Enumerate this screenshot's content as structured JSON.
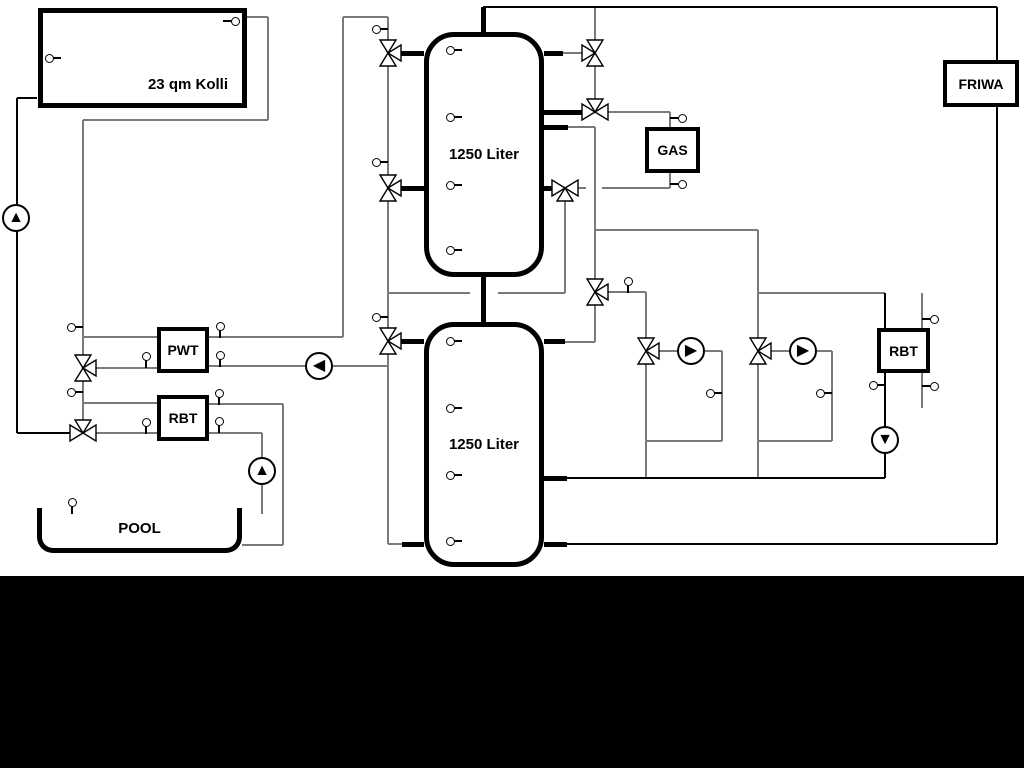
{
  "labels": {
    "collector": "23 qm Kolli",
    "tank_top": "1250 Liter",
    "tank_bottom": "1250 Liter",
    "gas": "GAS",
    "friwa": "FRIWA",
    "pwt": "PWT",
    "rbt_left": "RBT",
    "rbt_right": "RBT",
    "pool": "POOL"
  },
  "colors": {
    "background": "#ffffff",
    "bottom_bar": "#000000",
    "pipe_gray": "#7a7a7a",
    "pipe_black": "#000000",
    "symbol_fill": "#ffffff",
    "symbol_stroke": "#000000"
  },
  "icons": {
    "pump_up": "▲",
    "pump_down": "▼",
    "pump_left": "◀",
    "pump_right": "▶",
    "valve_3way": "bowtie-with-side-triangle",
    "sensor": "small-circle-with-stem"
  },
  "diagram": {
    "bottom_bar": {
      "x": 0,
      "y": 576,
      "w": 1024,
      "h": 192
    },
    "boxes": [
      {
        "id": "collector",
        "label_key": "labels.collector",
        "x": 38,
        "y": 8,
        "w": 209,
        "h": 100,
        "bw": 5,
        "fs": 15,
        "lbl_pos": "br",
        "name": "solar-collector-box"
      },
      {
        "id": "gas",
        "label_key": "labels.gas",
        "x": 645,
        "y": 127,
        "w": 55,
        "h": 46,
        "bw": 4,
        "fs": 14,
        "lbl_pos": "c",
        "name": "gas-boiler-box"
      },
      {
        "id": "friwa",
        "label_key": "labels.friwa",
        "x": 943,
        "y": 60,
        "w": 76,
        "h": 47,
        "bw": 4,
        "fs": 14,
        "lbl_pos": "c",
        "name": "friwa-station-box"
      },
      {
        "id": "pwt",
        "label_key": "labels.pwt",
        "x": 157,
        "y": 327,
        "w": 52,
        "h": 46,
        "bw": 4,
        "fs": 14,
        "lbl_pos": "c",
        "name": "pwt-heat-exchanger-box"
      },
      {
        "id": "rbt_left",
        "label_key": "labels.rbt_left",
        "x": 157,
        "y": 395,
        "w": 52,
        "h": 46,
        "bw": 4,
        "fs": 14,
        "lbl_pos": "c",
        "name": "rbt-heat-exchanger-left-box"
      },
      {
        "id": "rbt_right",
        "label_key": "labels.rbt_right",
        "x": 877,
        "y": 328,
        "w": 53,
        "h": 45,
        "bw": 4,
        "fs": 14,
        "lbl_pos": "c",
        "name": "rbt-heat-exchanger-right-box"
      }
    ],
    "tanks": [
      {
        "id": "tank_top",
        "label_key": "labels.tank_top",
        "x": 424,
        "y": 32,
        "w": 120,
        "h": 245,
        "name": "buffer-tank-top"
      },
      {
        "id": "tank_bottom",
        "label_key": "labels.tank_bottom",
        "x": 424,
        "y": 322,
        "w": 120,
        "h": 245,
        "name": "buffer-tank-bottom"
      }
    ],
    "pool": {
      "label_key": "labels.pool",
      "x": 37,
      "y": 508,
      "w": 205,
      "h": 45,
      "name": "pool-basin"
    },
    "pipes": [
      [
        17,
        98,
        37,
        98,
        2,
        "k"
      ],
      [
        17,
        98,
        17,
        433,
        2,
        "k"
      ],
      [
        17,
        433,
        70,
        433,
        2,
        "k"
      ],
      [
        247,
        17,
        268,
        17,
        2,
        "g"
      ],
      [
        268,
        17,
        268,
        120,
        2,
        "g"
      ],
      [
        83,
        120,
        268,
        120,
        2,
        "g"
      ],
      [
        83,
        120,
        83,
        355,
        2,
        "g"
      ],
      [
        83,
        381,
        83,
        420,
        2,
        "g"
      ],
      [
        83,
        337,
        157,
        337,
        2,
        "g"
      ],
      [
        96,
        368,
        157,
        368,
        2,
        "g"
      ],
      [
        209,
        337,
        343,
        337,
        2,
        "g"
      ],
      [
        343,
        17,
        343,
        337,
        2,
        "g"
      ],
      [
        343,
        17,
        388,
        17,
        2,
        "g"
      ],
      [
        209,
        366,
        388,
        366,
        2,
        "g"
      ],
      [
        83,
        403,
        157,
        403,
        2,
        "g"
      ],
      [
        96,
        433,
        157,
        433,
        2,
        "g"
      ],
      [
        209,
        404,
        283,
        404,
        2,
        "g"
      ],
      [
        283,
        404,
        283,
        545,
        2,
        "g"
      ],
      [
        242,
        545,
        283,
        545,
        2,
        "g"
      ],
      [
        209,
        433,
        262,
        433,
        2,
        "g"
      ],
      [
        262,
        433,
        262,
        514,
        2,
        "g"
      ],
      [
        388,
        17,
        388,
        40,
        2,
        "g"
      ],
      [
        388,
        66,
        388,
        175,
        2,
        "g"
      ],
      [
        388,
        201,
        388,
        328,
        2,
        "g"
      ],
      [
        388,
        354,
        388,
        544,
        2,
        "g"
      ],
      [
        388,
        544,
        402,
        544,
        2,
        "g"
      ],
      [
        388,
        293,
        470,
        293,
        2,
        "g"
      ],
      [
        498,
        293,
        565,
        293,
        2,
        "g"
      ],
      [
        565,
        201,
        565,
        293,
        2,
        "g"
      ],
      [
        578,
        188,
        586,
        188,
        2,
        "g"
      ],
      [
        602,
        188,
        670,
        188,
        2,
        "g"
      ],
      [
        670,
        173,
        670,
        188,
        2,
        "g"
      ],
      [
        608,
        112,
        670,
        112,
        2,
        "g"
      ],
      [
        670,
        112,
        670,
        127,
        2,
        "g"
      ],
      [
        568,
        127,
        595,
        127,
        2,
        "g"
      ],
      [
        595,
        127,
        595,
        279,
        2,
        "g"
      ],
      [
        595,
        305,
        595,
        342,
        2,
        "g"
      ],
      [
        565,
        342,
        595,
        342,
        2,
        "g"
      ],
      [
        595,
        7,
        595,
        40,
        2,
        "g"
      ],
      [
        595,
        66,
        595,
        99,
        2,
        "g"
      ],
      [
        563,
        53,
        582,
        53,
        2,
        "g"
      ],
      [
        595,
        230,
        758,
        230,
        2,
        "g"
      ],
      [
        758,
        230,
        758,
        338,
        2,
        "g"
      ],
      [
        608,
        292,
        646,
        292,
        2,
        "g"
      ],
      [
        646,
        292,
        646,
        338,
        2,
        "g"
      ],
      [
        646,
        364,
        646,
        478,
        2,
        "g"
      ],
      [
        659,
        351,
        677,
        351,
        2,
        "g"
      ],
      [
        705,
        351,
        722,
        351,
        2,
        "g"
      ],
      [
        722,
        351,
        722,
        441,
        2,
        "g"
      ],
      [
        646,
        441,
        722,
        441,
        2,
        "g"
      ],
      [
        771,
        351,
        789,
        351,
        2,
        "g"
      ],
      [
        817,
        351,
        832,
        351,
        2,
        "g"
      ],
      [
        832,
        351,
        832,
        441,
        2,
        "g"
      ],
      [
        758,
        441,
        832,
        441,
        2,
        "g"
      ],
      [
        758,
        364,
        758,
        478,
        2,
        "g"
      ],
      [
        758,
        293,
        885,
        293,
        2,
        "g"
      ],
      [
        885,
        293,
        885,
        328,
        2,
        "k"
      ],
      [
        885,
        373,
        885,
        426,
        2,
        "k"
      ],
      [
        885,
        454,
        885,
        478,
        2,
        "k"
      ],
      [
        922,
        293,
        922,
        328,
        2,
        "g"
      ],
      [
        922,
        373,
        922,
        408,
        2,
        "g"
      ],
      [
        567,
        478,
        885,
        478,
        2,
        "k"
      ],
      [
        567,
        544,
        997,
        544,
        2,
        "k"
      ],
      [
        997,
        7,
        997,
        544,
        2,
        "k"
      ],
      [
        483,
        7,
        997,
        7,
        2,
        "k"
      ],
      [
        483,
        7,
        483,
        32,
        5,
        "k"
      ],
      [
        483,
        277,
        483,
        322,
        5,
        "k"
      ],
      [
        401,
        53,
        424,
        53,
        5,
        "k"
      ],
      [
        401,
        188,
        424,
        188,
        5,
        "k"
      ],
      [
        544,
        53,
        563,
        53,
        5,
        "k"
      ],
      [
        544,
        112,
        582,
        112,
        5,
        "k"
      ],
      [
        544,
        127,
        568,
        127,
        5,
        "k"
      ],
      [
        544,
        188,
        553,
        188,
        5,
        "k"
      ],
      [
        401,
        341,
        424,
        341,
        5,
        "k"
      ],
      [
        402,
        544,
        424,
        544,
        5,
        "k"
      ],
      [
        544,
        341,
        565,
        341,
        5,
        "k"
      ],
      [
        544,
        478,
        567,
        478,
        5,
        "k"
      ],
      [
        544,
        544,
        567,
        544,
        5,
        "k"
      ]
    ],
    "valves": [
      {
        "x": 388,
        "y": 53,
        "axis": "v",
        "side": "r",
        "name": "valve-tank1-top-left"
      },
      {
        "x": 388,
        "y": 188,
        "axis": "v",
        "side": "r",
        "name": "valve-tank1-mid-left"
      },
      {
        "x": 388,
        "y": 341,
        "axis": "v",
        "side": "r",
        "name": "valve-tank2-top-left"
      },
      {
        "x": 83,
        "y": 368,
        "axis": "v",
        "side": "r",
        "name": "valve-solar-pwt"
      },
      {
        "x": 83,
        "y": 433,
        "axis": "h",
        "side": "t",
        "name": "valve-solar-rbt"
      },
      {
        "x": 595,
        "y": 53,
        "axis": "v",
        "side": "l",
        "name": "valve-tank1-top-right"
      },
      {
        "x": 595,
        "y": 112,
        "axis": "h",
        "side": "t",
        "name": "valve-gas-supply"
      },
      {
        "x": 595,
        "y": 292,
        "axis": "v",
        "side": "r",
        "name": "valve-distribution"
      },
      {
        "x": 565,
        "y": 188,
        "axis": "h",
        "side": "b",
        "name": "valve-gas-return"
      },
      {
        "x": 646,
        "y": 351,
        "axis": "v",
        "side": "r",
        "name": "valve-heating-circuit-1"
      },
      {
        "x": 758,
        "y": 351,
        "axis": "v",
        "side": "r",
        "name": "valve-heating-circuit-2"
      }
    ],
    "pumps": [
      {
        "x": 16,
        "y": 218,
        "dir": "up",
        "name": "pump-solar"
      },
      {
        "x": 319,
        "y": 366,
        "dir": "left",
        "name": "pump-pwt-charge"
      },
      {
        "x": 691,
        "y": 351,
        "dir": "right",
        "name": "pump-heating-circuit-1"
      },
      {
        "x": 803,
        "y": 351,
        "dir": "right",
        "name": "pump-heating-circuit-2"
      },
      {
        "x": 885,
        "y": 440,
        "dir": "down",
        "name": "pump-rbt-right"
      },
      {
        "x": 262,
        "y": 471,
        "dir": "up",
        "name": "pump-pool"
      }
    ],
    "sensors": [
      {
        "x": 49,
        "y": 58,
        "dir": "r"
      },
      {
        "x": 235,
        "y": 21,
        "dir": "l"
      },
      {
        "x": 450,
        "y": 50,
        "dir": "r"
      },
      {
        "x": 450,
        "y": 117,
        "dir": "r"
      },
      {
        "x": 450,
        "y": 185,
        "dir": "r"
      },
      {
        "x": 450,
        "y": 250,
        "dir": "r"
      },
      {
        "x": 450,
        "y": 341,
        "dir": "r"
      },
      {
        "x": 450,
        "y": 408,
        "dir": "r"
      },
      {
        "x": 450,
        "y": 475,
        "dir": "r"
      },
      {
        "x": 450,
        "y": 541,
        "dir": "r"
      },
      {
        "x": 376,
        "y": 29,
        "dir": "r"
      },
      {
        "x": 376,
        "y": 162,
        "dir": "r"
      },
      {
        "x": 376,
        "y": 317,
        "dir": "r"
      },
      {
        "x": 71,
        "y": 327,
        "dir": "r"
      },
      {
        "x": 71,
        "y": 392,
        "dir": "r"
      },
      {
        "x": 220,
        "y": 326,
        "dir": "d"
      },
      {
        "x": 146,
        "y": 356,
        "dir": "d"
      },
      {
        "x": 220,
        "y": 355,
        "dir": "d"
      },
      {
        "x": 219,
        "y": 393,
        "dir": "d"
      },
      {
        "x": 146,
        "y": 422,
        "dir": "d"
      },
      {
        "x": 219,
        "y": 421,
        "dir": "d"
      },
      {
        "x": 682,
        "y": 118,
        "dir": "l"
      },
      {
        "x": 682,
        "y": 184,
        "dir": "l"
      },
      {
        "x": 628,
        "y": 281,
        "dir": "d"
      },
      {
        "x": 710,
        "y": 393,
        "dir": "r"
      },
      {
        "x": 820,
        "y": 393,
        "dir": "r"
      },
      {
        "x": 873,
        "y": 385,
        "dir": "r"
      },
      {
        "x": 934,
        "y": 319,
        "dir": "l"
      },
      {
        "x": 934,
        "y": 386,
        "dir": "l"
      },
      {
        "x": 72,
        "y": 502,
        "dir": "d"
      }
    ]
  }
}
